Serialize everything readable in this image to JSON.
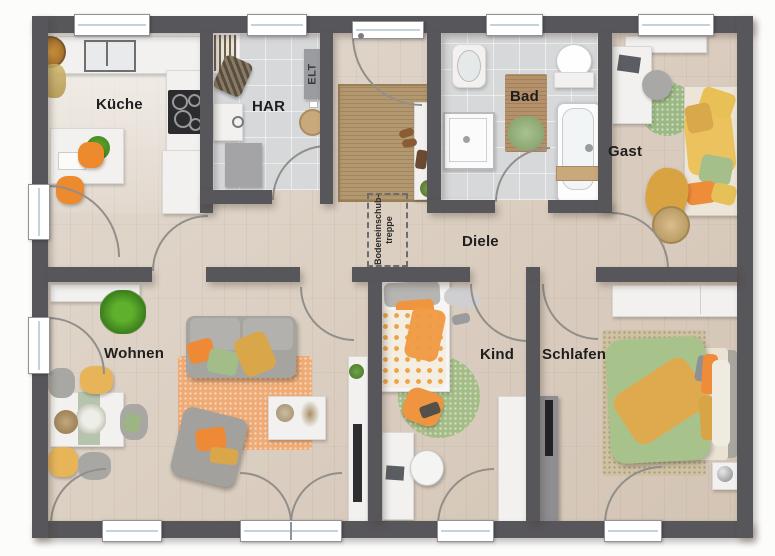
{
  "plan": {
    "rooms": {
      "kueche": {
        "label": "Küche"
      },
      "har": {
        "label": "HAR"
      },
      "bad": {
        "label": "Bad"
      },
      "gast": {
        "label": "Gast"
      },
      "diele": {
        "label": "Diele"
      },
      "wohnen": {
        "label": "Wohnen"
      },
      "kind": {
        "label": "Kind"
      },
      "schlafen": {
        "label": "Schlafen"
      }
    },
    "labels": {
      "elt": "ELT",
      "attic_line1": "Bodeneinschub-",
      "attic_line2": "treppe"
    },
    "colors": {
      "wall": "#57565a",
      "floor_wood": "#d9ccbe",
      "floor_tile": "#d7d8da",
      "accent_orange": "#ee8a35",
      "accent_mustard": "#dca74c",
      "accent_green": "#a5bf8b",
      "rug_jute": "#b3986f",
      "rug_orange": "#eeab76",
      "rug_bedroom": "#cfc2a2",
      "label_text": "#1e1e1e"
    }
  }
}
